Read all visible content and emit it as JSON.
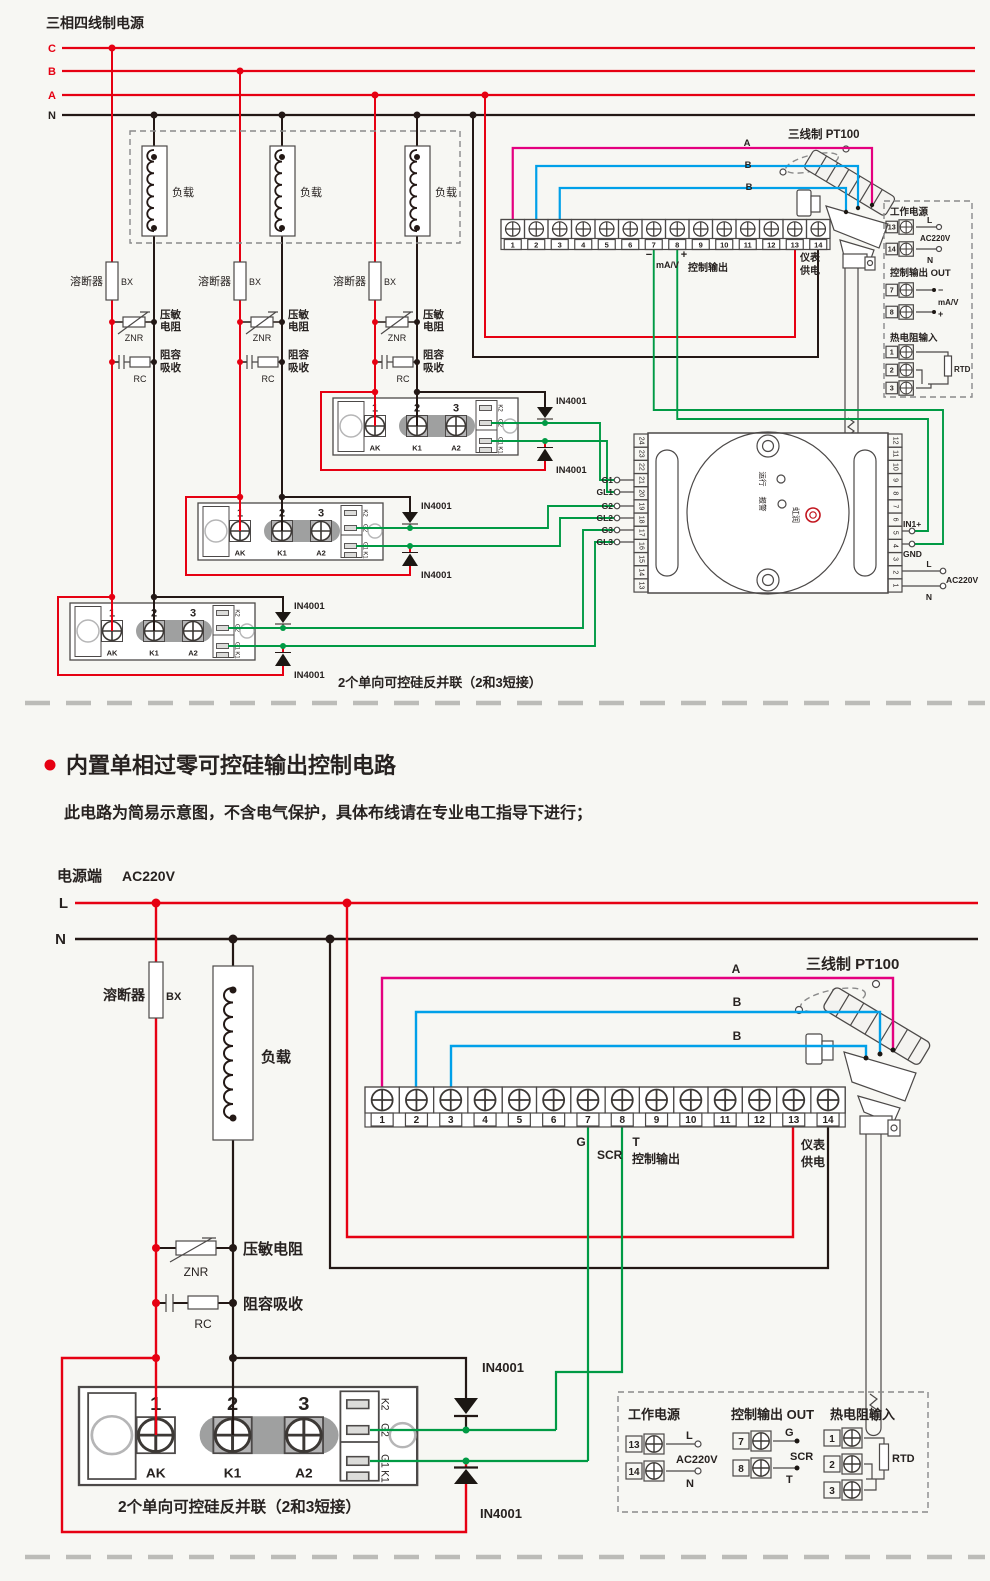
{
  "colors": {
    "red": "#e60012",
    "black": "#231815",
    "green": "#009a44",
    "magenta": "#e4007f",
    "blue": "#00a0e9",
    "gray": "#9fa0a0"
  },
  "common": {
    "load": "负载",
    "fuse": "溶断器",
    "fuse_code": "BX",
    "znr": "ZNR",
    "rc": "RC",
    "varistor": "压敏电阻",
    "varistor_l1": "压敏",
    "varistor_l2": "电阻",
    "snubber": "阻容吸收",
    "snubber_l1": "阻容",
    "snubber_l2": "吸收",
    "diode": "IN4001",
    "pt100": "三线制 PT100",
    "wire_a": "A",
    "wire_b": "B",
    "terminal_numbers": [
      "1",
      "2",
      "3",
      "4",
      "5",
      "6",
      "7",
      "8",
      "9",
      "10",
      "11",
      "12",
      "13",
      "14"
    ],
    "module": {
      "n1": "1",
      "n2": "2",
      "n3": "3",
      "ak": "AK",
      "k1": "K1",
      "a2": "A2",
      "side": [
        "K2",
        "G2",
        "G1",
        "K1"
      ]
    },
    "minus": "−",
    "plus": "+",
    "mav": "mA/V",
    "ctrl_label": "控制输出",
    "meter_l1": "仪表",
    "meter_l2": "供电",
    "caption": "2个单向可控硅反并联（2和3短接）",
    "ac220v": "AC220V",
    "l": "L",
    "n": "N",
    "work_power": "工作电源",
    "ctrl_out": "控制输出 OUT",
    "rtd_in": "热电阻输入",
    "rtd": "RTD",
    "panel": {
      "t13": "13",
      "t14": "14",
      "t7": "7",
      "t8": "8",
      "r1": "1",
      "r2": "2",
      "r3": "3"
    }
  },
  "top": {
    "title": "三相四线制电源",
    "phases": [
      "C",
      "B",
      "A",
      "N"
    ],
    "controller": {
      "left": [
        "24",
        "23",
        "22",
        "21",
        "20",
        "19",
        "18",
        "17",
        "16",
        "15",
        "14",
        "13"
      ],
      "right": [
        "12",
        "11",
        "10",
        "9",
        "8",
        "7",
        "6",
        "5",
        "4",
        "3",
        "2",
        "1"
      ],
      "gates": [
        "G1",
        "GL1",
        "G2",
        "GL2",
        "G3",
        "GL3"
      ],
      "in1": "IN1+",
      "gnd": "GND",
      "run": "运行",
      "alarm": "报警",
      "brand": "虹润"
    }
  },
  "section": {
    "title": "内置单相过零可控硅输出控制电路",
    "subtitle": "此电路为简易示意图，不含电气保护，具体布线请在专业电工指导下进行；"
  },
  "bottom": {
    "source": "电源端",
    "g": "G",
    "scr": "SCR",
    "t": "T"
  }
}
